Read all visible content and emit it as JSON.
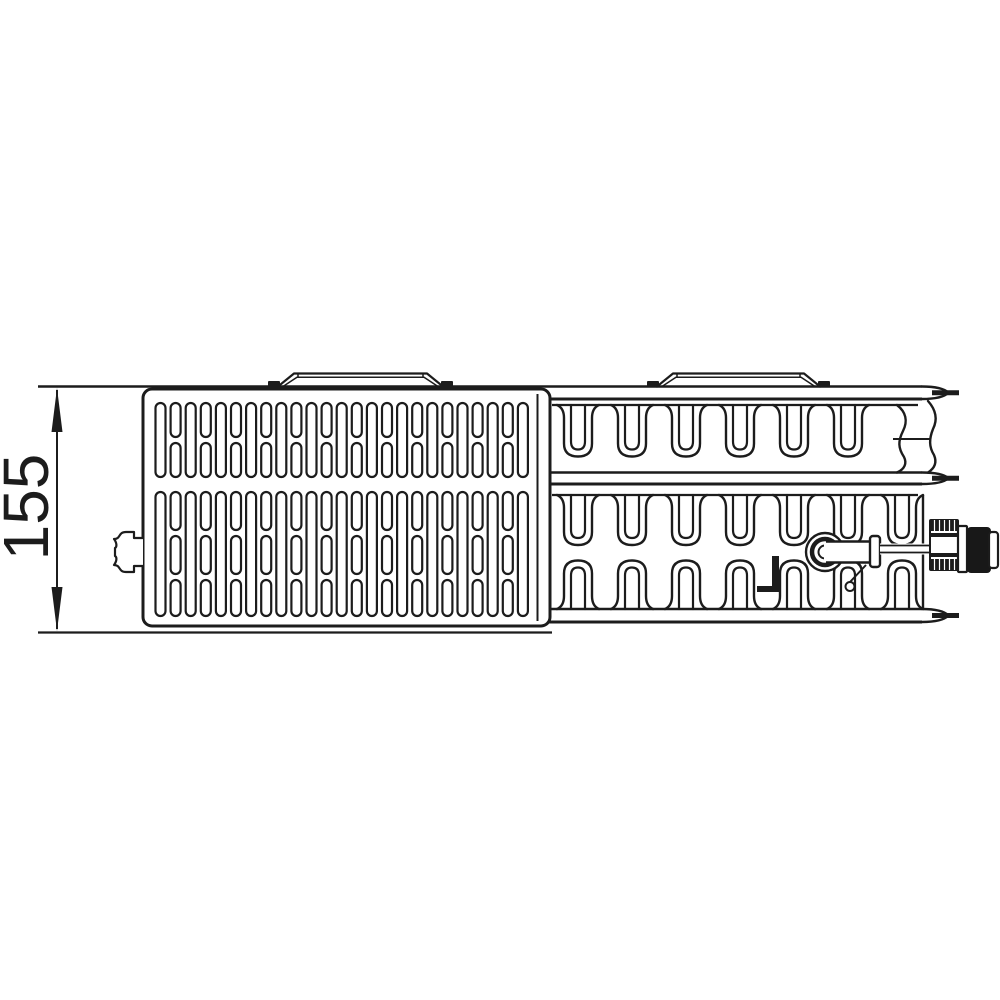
{
  "drawing": {
    "stroke_color": "#1c1c1c",
    "background_color": "#ffffff",
    "dimension": {
      "label": "155",
      "font_size": 64,
      "label_cx": 26,
      "label_cy": 507,
      "label_rotation": -90,
      "line_x": 57,
      "y_top": 388,
      "y_bottom": 631,
      "arrow_len": 44,
      "arrow_half_w": 5.5,
      "ext_x0": 38,
      "ext_y_top": 386.5,
      "ext_y_bottom": 632.5,
      "ext_x1": 552
    },
    "grille": {
      "x": 143,
      "y": 389,
      "w": 407,
      "h": 237,
      "rx": 9,
      "stroke_w": 3,
      "inner_edge_x": 537.5,
      "inner_edge_y0": 394,
      "inner_edge_y1": 621,
      "slot_x0": 155.5,
      "pitch": 15.1,
      "slot_w": 10,
      "columns": 25,
      "slot_rx": 5,
      "slot_stroke": 2.2,
      "top_band": {
        "tall": {
          "y": 403,
          "h": 74
        },
        "stack": [
          {
            "y": 403,
            "h": 34
          },
          {
            "y": 443,
            "h": 34
          }
        ]
      },
      "bottom_band": {
        "tall": {
          "y": 492,
          "h": 124
        },
        "stack": [
          {
            "y": 492,
            "h": 38
          },
          {
            "y": 536,
            "h": 38
          },
          {
            "y": 580,
            "h": 36
          }
        ]
      },
      "plug_path": "M143,538 L134,538 L134,532 L126,532 C118,532 121,539 114,539 C117,543 117,547 115,548 L115,556 C117,557 117,561 114,565 C121,565 118,572 126,572 L134,572 L134,566 L143,566"
    },
    "brackets": [
      {
        "x0": 268,
        "x1": 453,
        "base_y": 386.5,
        "top_y": 373.5,
        "inner_y": 377.2
      },
      {
        "x0": 647,
        "x1": 830,
        "base_y": 386.5,
        "top_y": 373.5,
        "inner_y": 377.2
      }
    ],
    "panel_bands": [
      {
        "yu": 386.5,
        "yl": 399,
        "x0": 549,
        "x1": 922,
        "tip_x": 948.5,
        "stub_y": 392.7,
        "upper_from": 38
      },
      {
        "yu": 472.5,
        "yl": 484,
        "x0": 549,
        "x1": 922,
        "tip_x": 948.5,
        "stub_y": 478.2,
        "upper_from": 549
      },
      {
        "yu": 609,
        "yl": 622,
        "x0": 549,
        "x1": 922,
        "tip_x": 948.5,
        "stub_y": 615.5,
        "upper_from": 549
      }
    ],
    "stub_x0": 932,
    "stub_x1": 959,
    "stub_w": 5,
    "fin_base_lines": [
      {
        "y": 405,
        "x0": 552,
        "x1": 918
      },
      {
        "y": 495,
        "x0": 552,
        "x1": 918
      }
    ],
    "fin_geometry": {
      "shoulder_half": 21,
      "outer_half": 14,
      "inner_half": 7,
      "outer_r": 13,
      "inner_r": 8,
      "neck_r": 10
    },
    "fin_rows": [
      {
        "dir": 1,
        "base_y": 405,
        "tip_y": 456.5,
        "centers": [
          578,
          632,
          686,
          740,
          794,
          848
        ]
      },
      {
        "dir": 1,
        "base_y": 495,
        "tip_y": 545,
        "centers": [
          578,
          632,
          686,
          740,
          794,
          848,
          902
        ]
      },
      {
        "dir": -1,
        "base_y": 609,
        "tip_y": 560.5,
        "centers": [
          578,
          632,
          686,
          740,
          794,
          848,
          902
        ]
      }
    ],
    "end_channel": {
      "left_wall": "M897,405 C906,412 908,421 903,431 C898,441 898,448 904,457 C907,463 905,469 897,472.5",
      "right_wall": "M928,401 C936,410 938,419 933,429 C929,439 929,447 934,455 C937,462 935,468 928,472.5",
      "hline": {
        "x0": 893,
        "x1": 931,
        "y": 439
      }
    },
    "end_wall": {
      "x": 923,
      "y0": 495,
      "y1": 609
    },
    "weld_tick_points": "772,556 779,556 779,592 757,592 757,586 772,586",
    "valve": {
      "cx": 825,
      "cy": 552,
      "r_outer": 19,
      "r_ring": 13,
      "ring_w": 4.5,
      "r_inner": 6.5,
      "tube": {
        "x0": 824,
        "x1": 872,
        "y_top": 541.5,
        "y_bot": 562.5
      },
      "flange": {
        "x": 870,
        "y": 536,
        "w": 10,
        "h": 31,
        "rx": 3
      },
      "rod": {
        "x0": 880,
        "x1": 932,
        "y_top": 545.5,
        "y_bot": 552.5
      },
      "diagonal": {
        "x0": 866,
        "y0": 565,
        "x1": 850,
        "y1": 582
      },
      "drain_circle": {
        "cx": 850,
        "cy": 586.5,
        "r": 4.5
      },
      "block": {
        "x": 930,
        "y": 520,
        "w": 28,
        "h": 50,
        "dark_bands": [
          [
            520,
            11
          ],
          [
            533,
            4
          ],
          [
            553,
            4
          ],
          [
            559,
            11
          ]
        ],
        "rib_xs": [
          934.5,
          939.5,
          944.5,
          949.5,
          954.5
        ]
      },
      "collar": {
        "x": 958,
        "y": 526,
        "w": 9,
        "h": 46
      },
      "cap": {
        "x": 967,
        "y": 527,
        "w": 24,
        "h": 46,
        "rx": 4,
        "fill": "#181818"
      },
      "cap_face": {
        "x": 989,
        "y": 532,
        "w": 9,
        "h": 36,
        "rx": 3
      }
    }
  }
}
